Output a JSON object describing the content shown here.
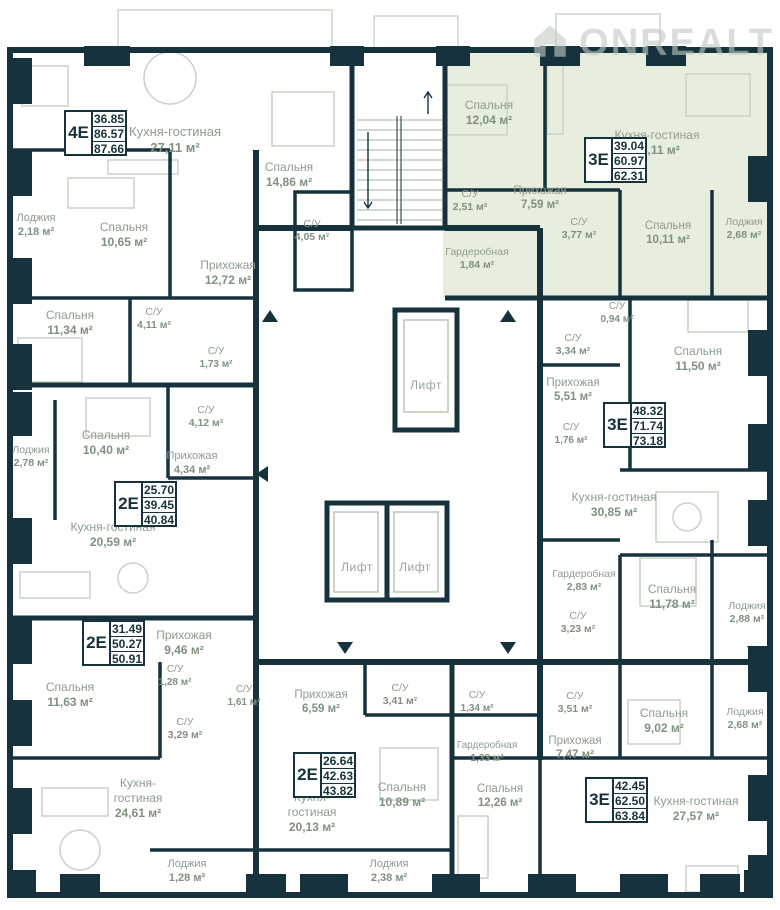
{
  "watermark": {
    "text": "ONREALT"
  },
  "colors": {
    "wall": "#16323c",
    "apartment_highlight": "#e7eedd",
    "label_text": "#8d9c8f",
    "area_text": "#7f9280",
    "badge_text": "#16323c",
    "furniture": "#c6d3c4"
  },
  "common_areas": {
    "elevator_label": "Лифт",
    "elevators": [
      {
        "x": 426,
        "y": 378
      },
      {
        "x": 357,
        "y": 560
      },
      {
        "x": 415,
        "y": 560
      }
    ]
  },
  "entry_arrows": [
    {
      "dir": "up",
      "x": 270,
      "y": 310
    },
    {
      "dir": "up",
      "x": 508,
      "y": 310
    },
    {
      "dir": "down",
      "x": 345,
      "y": 642
    },
    {
      "dir": "down",
      "x": 508,
      "y": 642
    },
    {
      "dir": "down",
      "x": 755,
      "y": 646
    },
    {
      "dir": "left",
      "x": 262,
      "y": 468
    }
  ],
  "apartments": [
    {
      "id": "apt-4e",
      "type": "4E",
      "area_values": [
        "36.85",
        "86.57",
        "87.66"
      ],
      "badge_pos": {
        "x": 64,
        "y": 110
      },
      "rooms": [
        {
          "lines": [
            "Кухня-гостиная",
            "27,11 м²"
          ],
          "x": 175,
          "y": 124,
          "fs": 13
        },
        {
          "lines": [
            "Лоджия",
            "2,18 м²"
          ],
          "x": 36,
          "y": 212,
          "fs": 11
        },
        {
          "lines": [
            "Спальня",
            "10,65 м²"
          ],
          "x": 124,
          "y": 220,
          "fs": 12
        },
        {
          "lines": [
            "Спальня",
            "14,86 м²"
          ],
          "x": 289,
          "y": 160,
          "fs": 12
        },
        {
          "lines": [
            "Прихожая",
            "12,72 м²"
          ],
          "x": 228,
          "y": 258,
          "fs": 12
        },
        {
          "lines": [
            "С/У",
            "4,05 м²"
          ],
          "x": 312,
          "y": 218,
          "fs": 10.5
        },
        {
          "lines": [
            "Спальня",
            "11,34 м²"
          ],
          "x": 70,
          "y": 308,
          "fs": 12
        },
        {
          "lines": [
            "С/У",
            "4,11 м²"
          ],
          "x": 154,
          "y": 306,
          "fs": 10.5
        },
        {
          "lines": [
            "С/У",
            "1,73 м²"
          ],
          "x": 216,
          "y": 346,
          "fs": 10
        }
      ]
    },
    {
      "id": "apt-2e-a",
      "type": "2E",
      "area_values": [
        "25.70",
        "39.45",
        "40.84"
      ],
      "badge_pos": {
        "x": 114,
        "y": 481
      },
      "rooms": [
        {
          "lines": [
            "Спальня",
            "10,40 м²"
          ],
          "x": 106,
          "y": 428,
          "fs": 12
        },
        {
          "lines": [
            "С/У",
            "4,12 м²"
          ],
          "x": 206,
          "y": 404,
          "fs": 10.5
        },
        {
          "lines": [
            "Прихожая",
            "4,34 м²"
          ],
          "x": 192,
          "y": 450,
          "fs": 11
        },
        {
          "lines": [
            "Кухня-гостиная",
            "20,59 м²"
          ],
          "x": 113,
          "y": 520,
          "fs": 12
        },
        {
          "lines": [
            "Лоджия",
            "2,78 м²"
          ],
          "x": 31,
          "y": 444,
          "fs": 10.5
        }
      ]
    },
    {
      "id": "apt-2e-b",
      "type": "2E",
      "area_values": [
        "31.49",
        "50.27",
        "50.91"
      ],
      "badge_pos": {
        "x": 82,
        "y": 620
      },
      "rooms": [
        {
          "lines": [
            "Прихожая",
            "9,46 м²"
          ],
          "x": 184,
          "y": 628,
          "fs": 12
        },
        {
          "lines": [
            "С/У",
            "1,28 м²"
          ],
          "x": 175,
          "y": 664,
          "fs": 10
        },
        {
          "lines": [
            "Спальня",
            "11,63 м²"
          ],
          "x": 70,
          "y": 680,
          "fs": 12
        },
        {
          "lines": [
            "С/У",
            "3,29 м²"
          ],
          "x": 185,
          "y": 716,
          "fs": 10.5
        },
        {
          "lines": [
            "Кухня-",
            "гостиная",
            "24,61 м²"
          ],
          "x": 138,
          "y": 776,
          "fs": 12
        },
        {
          "lines": [
            "Лоджия",
            "1,28 м²"
          ],
          "x": 187,
          "y": 858,
          "fs": 11
        }
      ]
    },
    {
      "id": "apt-3e-a",
      "type": "3E",
      "highlighted": true,
      "area_values": [
        "39.04",
        "60.97",
        "62.31"
      ],
      "badge_pos": {
        "x": 584,
        "y": 137
      },
      "rooms": [
        {
          "lines": [
            "Спальня",
            "12,04 м²"
          ],
          "x": 489,
          "y": 98,
          "fs": 12
        },
        {
          "lines": [
            "Кухня-гостиная",
            "23,11 м²"
          ],
          "x": 657,
          "y": 128,
          "fs": 12
        },
        {
          "lines": [
            "С/У",
            "2,51 м²"
          ],
          "x": 470,
          "y": 188,
          "fs": 10.5
        },
        {
          "lines": [
            "Прихожая",
            "7,59 м²"
          ],
          "x": 540,
          "y": 184,
          "fs": 11.5
        },
        {
          "lines": [
            "С/У",
            "3,77 м²"
          ],
          "x": 579,
          "y": 216,
          "fs": 10.5
        },
        {
          "lines": [
            "Спальня",
            "10,11 м²"
          ],
          "x": 668,
          "y": 219,
          "fs": 11.5
        },
        {
          "lines": [
            "Лоджия",
            "2,68 м²"
          ],
          "x": 744,
          "y": 216,
          "fs": 10.5
        },
        {
          "lines": [
            "Гардеробная",
            "1,84 м²"
          ],
          "x": 477,
          "y": 246,
          "fs": 10.5
        }
      ]
    },
    {
      "id": "apt-3e-b",
      "type": "3E",
      "area_values": [
        "48.32",
        "71.74",
        "73.18"
      ],
      "badge_pos": {
        "x": 603,
        "y": 402
      },
      "rooms": [
        {
          "lines": [
            "С/У",
            "0,94 м²"
          ],
          "x": 617,
          "y": 301,
          "fs": 10
        },
        {
          "lines": [
            "С/У",
            "3,34 м²"
          ],
          "x": 573,
          "y": 332,
          "fs": 10.5
        },
        {
          "lines": [
            "Спальня",
            "11,50 м²"
          ],
          "x": 698,
          "y": 344,
          "fs": 12
        },
        {
          "lines": [
            "Прихожая",
            "5,51 м²"
          ],
          "x": 573,
          "y": 376,
          "fs": 11.5
        },
        {
          "lines": [
            "С/У",
            "1,76 м²"
          ],
          "x": 571,
          "y": 422,
          "fs": 10
        },
        {
          "lines": [
            "Кухня-гостиная",
            "30,85 м²"
          ],
          "x": 614,
          "y": 490,
          "fs": 12
        },
        {
          "lines": [
            "Гардеробная",
            "2,83 м²"
          ],
          "x": 584,
          "y": 568,
          "fs": 10.5
        },
        {
          "lines": [
            "Спальня",
            "11,78 м²"
          ],
          "x": 672,
          "y": 582,
          "fs": 12
        },
        {
          "lines": [
            "С/У",
            "3,23 м²"
          ],
          "x": 578,
          "y": 610,
          "fs": 10.5
        },
        {
          "lines": [
            "Лоджия",
            "2,88 м²"
          ],
          "x": 747,
          "y": 600,
          "fs": 10.5
        }
      ]
    },
    {
      "id": "apt-2e-c",
      "type": "2E",
      "area_values": [
        "26.64",
        "42.63",
        "43.82"
      ],
      "badge_pos": {
        "x": 293,
        "y": 752
      },
      "rooms": [
        {
          "lines": [
            "Прихожая",
            "6,59 м²"
          ],
          "x": 321,
          "y": 688,
          "fs": 11.5
        },
        {
          "lines": [
            "С/У",
            "3,41 м²"
          ],
          "x": 400,
          "y": 682,
          "fs": 10.5
        },
        {
          "lines": [
            "С/У",
            "1,61 м²"
          ],
          "x": 244,
          "y": 684,
          "fs": 10
        },
        {
          "lines": [
            "Спальня",
            "10,89 м²"
          ],
          "x": 402,
          "y": 780,
          "fs": 12
        },
        {
          "lines": [
            "Кухня-",
            "гостиная",
            "20,13 м²"
          ],
          "x": 312,
          "y": 790,
          "fs": 12
        },
        {
          "lines": [
            "Лоджия",
            "2,38 м²"
          ],
          "x": 389,
          "y": 858,
          "fs": 11
        }
      ]
    },
    {
      "id": "apt-3e-c",
      "type": "3E",
      "area_values": [
        "42.45",
        "62.50",
        "63.84"
      ],
      "badge_pos": {
        "x": 585,
        "y": 777
      },
      "rooms": [
        {
          "lines": [
            "С/У",
            "1,34 м²"
          ],
          "x": 477,
          "y": 690,
          "fs": 10
        },
        {
          "lines": [
            "Гардеробная",
            "1,33 м²"
          ],
          "x": 487,
          "y": 740,
          "fs": 10
        },
        {
          "lines": [
            "С/У",
            "3,51 м²"
          ],
          "x": 575,
          "y": 690,
          "fs": 10.5
        },
        {
          "lines": [
            "Спальня",
            "9,02 м²"
          ],
          "x": 664,
          "y": 706,
          "fs": 12
        },
        {
          "lines": [
            "Лоджия",
            "2,68 м²"
          ],
          "x": 745,
          "y": 706,
          "fs": 10.5
        },
        {
          "lines": [
            "Прихожая",
            "7,47 м²"
          ],
          "x": 575,
          "y": 734,
          "fs": 11.5
        },
        {
          "lines": [
            "Спальня",
            "12,26 м²"
          ],
          "x": 500,
          "y": 782,
          "fs": 11.5
        },
        {
          "lines": [
            "Кухня-гостиная",
            "27,57 м²"
          ],
          "x": 696,
          "y": 794,
          "fs": 12
        }
      ]
    }
  ]
}
